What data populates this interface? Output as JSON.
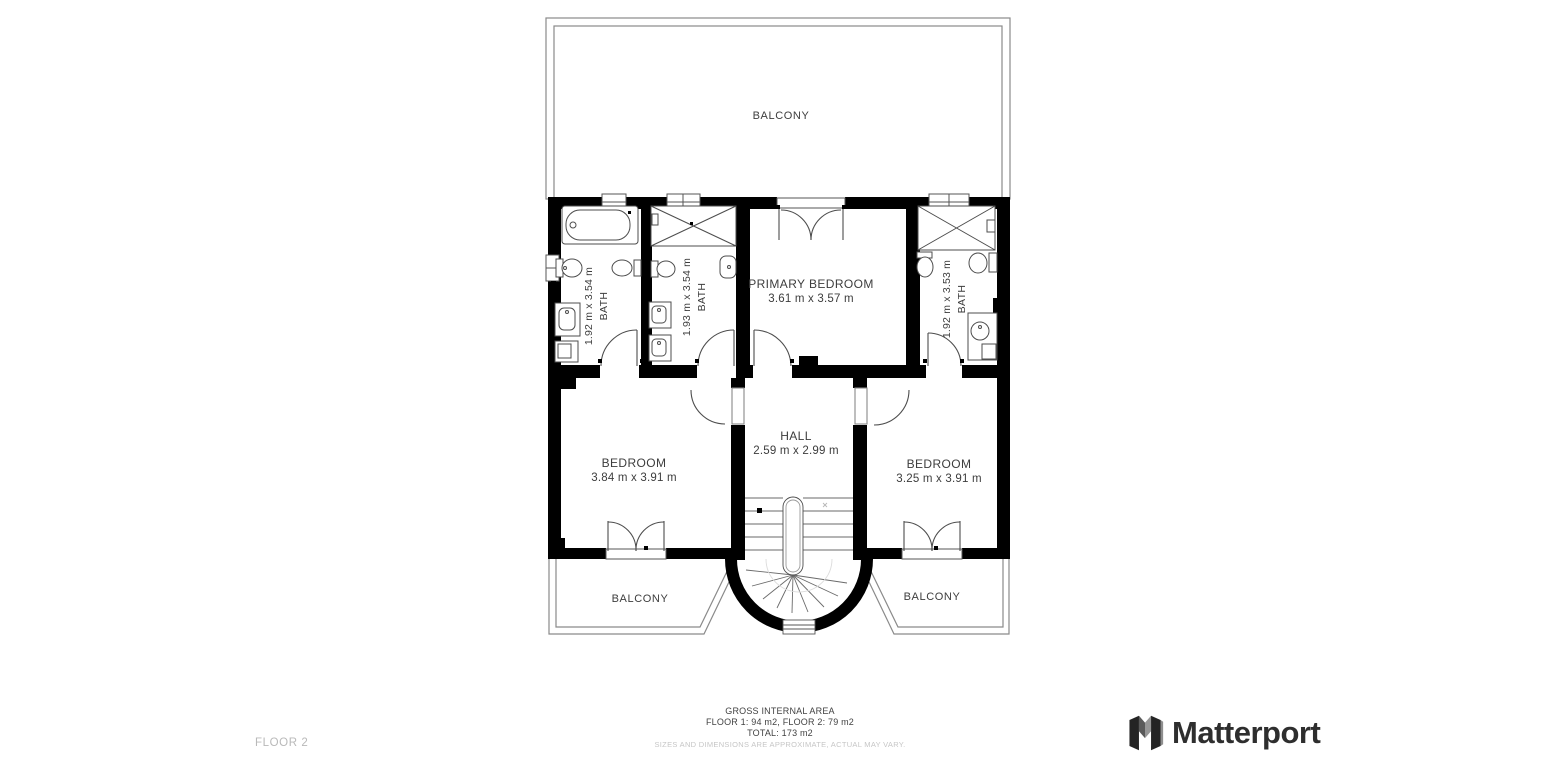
{
  "floor_label": "FLOOR 2",
  "brand": {
    "name": "Matterport"
  },
  "footer": {
    "title": "GROSS INTERNAL AREA",
    "floors": "FLOOR 1: 94 m2, FLOOR 2: 79 m2",
    "total": "TOTAL: 173 m2",
    "disclaimer": "SIZES AND DIMENSIONS ARE APPROXIMATE, ACTUAL MAY VARY."
  },
  "rooms": {
    "balcony_top": {
      "name": "BALCONY"
    },
    "bath_left": {
      "name": "BATH",
      "dims": "1.92 m x 3.54 m"
    },
    "bath_middle": {
      "name": "BATH",
      "dims": "1.93 m x 3.54 m"
    },
    "primary_bedroom": {
      "name": "PRIMARY BEDROOM",
      "dims": "3.61 m x 3.57 m"
    },
    "bath_right": {
      "name": "BATH",
      "dims": "1.92 m x 3.53 m"
    },
    "bedroom_left": {
      "name": "BEDROOM",
      "dims": "3.84 m x 3.91 m"
    },
    "hall": {
      "name": "HALL",
      "dims": "2.59 m x 2.99 m"
    },
    "bedroom_right": {
      "name": "BEDROOM",
      "dims": "3.25 m x 3.91 m"
    },
    "balcony_left": {
      "name": "BALCONY"
    },
    "balcony_right": {
      "name": "BALCONY"
    }
  },
  "colors": {
    "wall": "#000000",
    "fixture_line": "#4d4d4d",
    "balcony_line": "#8a8a8a",
    "text": "#3d3d3d",
    "muted_text": "#c6c6c6",
    "floor_label": "#b9b9b9",
    "brand_text": "#2e2e2e"
  }
}
